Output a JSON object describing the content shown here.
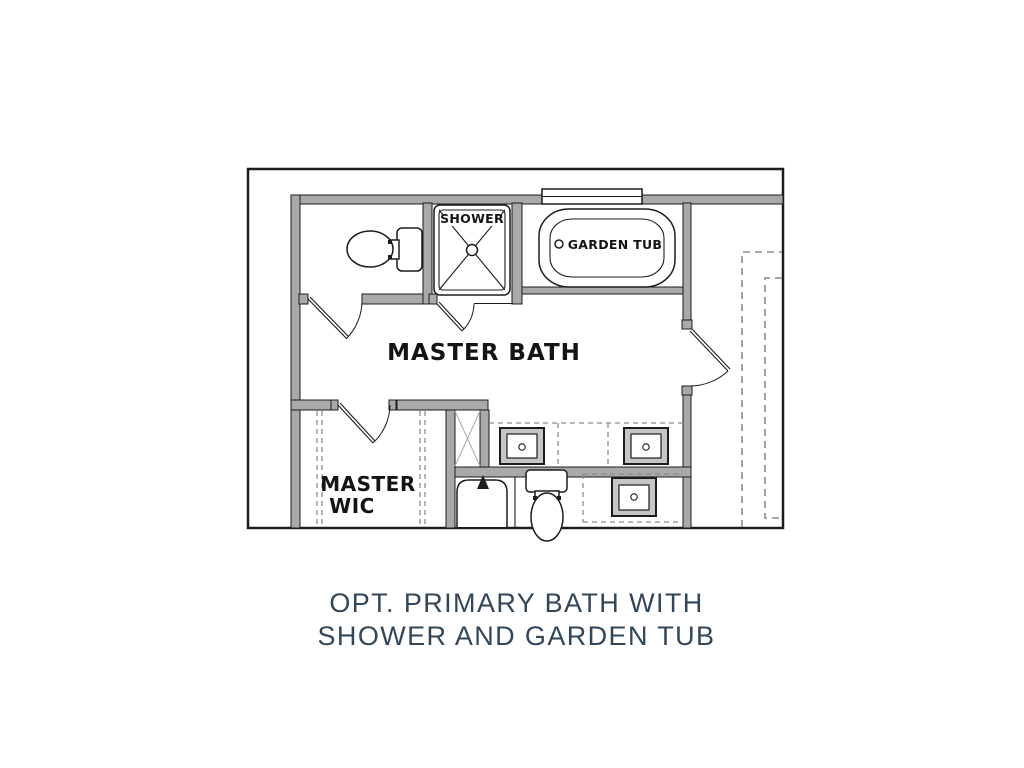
{
  "plan": {
    "labels": {
      "shower": "SHOWER",
      "garden_tub": "GARDEN TUB",
      "master_bath": "MASTER BATH",
      "wic_line1": "MASTER",
      "wic_line2": "WIC"
    }
  },
  "caption": {
    "line1": "OPT. PRIMARY BATH WITH",
    "line2": "SHOWER AND GARDEN TUB"
  },
  "colors": {
    "background": "#ffffff",
    "wall_fill": "#a9a9a9",
    "line": "#1c1c1c",
    "dashed": "#8a8a8a",
    "caption_text": "#32465a"
  }
}
